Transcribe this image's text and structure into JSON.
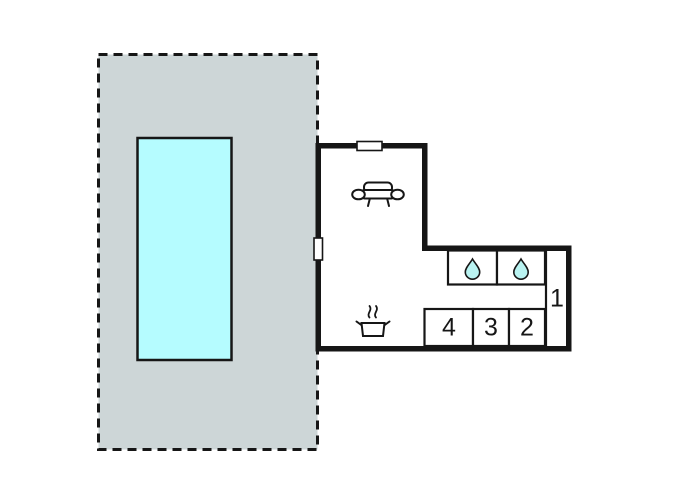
{
  "colors": {
    "background": "#ffffff",
    "ink": "#161616",
    "plot_fill": "#cdd6d7",
    "pool_fill": "#b5fcff",
    "drop_fill": "#b9f3f1"
  },
  "floorplan": {
    "outdoor": {
      "plot_name": "terrace-plot",
      "pool_name": "swimming-pool"
    },
    "rooms": {
      "room1": {
        "label": "1"
      },
      "room2": {
        "label": "2"
      },
      "room3": {
        "label": "3"
      },
      "room4": {
        "label": "4"
      }
    },
    "fixtures": [
      "sofa-icon",
      "stove-pot-icon",
      "water-drop-icon",
      "water-drop-icon",
      "window-top-icon",
      "window-left-icon"
    ]
  }
}
